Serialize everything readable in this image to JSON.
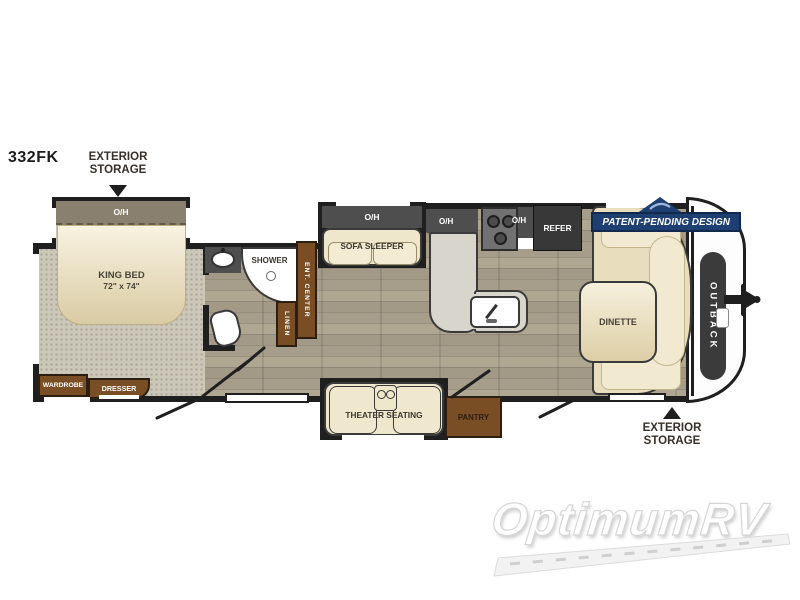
{
  "model": "332FK",
  "callouts": {
    "rear": [
      "EXTERIOR",
      "STORAGE"
    ],
    "front": [
      "EXTERIOR",
      "STORAGE"
    ]
  },
  "patent": {
    "text": "PATENT-PENDING DESIGN"
  },
  "front_cap": {
    "brand": "OUTBACK"
  },
  "watermark": {
    "text": "OptimumRV"
  },
  "bedroom": {
    "overhead": "O/H",
    "bed": [
      "KING BED",
      "72\" x 74\""
    ],
    "wardrobe": "WARDROBE",
    "dresser": "DRESSER"
  },
  "bathroom": {
    "shower": "SHOWER",
    "linen": "LINEN",
    "ent_center": "ENT. CENTER"
  },
  "living": {
    "sofa_overhead": "O/H",
    "sofa": "SOFA SLEEPER",
    "theater": "THEATER SEATING"
  },
  "kitchen": {
    "overhead_left": "O/H",
    "overhead_right": "O/H",
    "refrigerator": "REFER",
    "pantry": "PANTRY"
  },
  "dinette": {
    "label": "DINETTE"
  },
  "colors": {
    "wall": "#1f1f1f",
    "navy_banner": "#1e3f72",
    "cabinet_brown": "#7a4e24",
    "counter_dark": "#4e4e4e",
    "upholstery_cream": "#efe7cb",
    "wood_floor": "#a69d8a",
    "carpet": "#cbc7b9"
  }
}
